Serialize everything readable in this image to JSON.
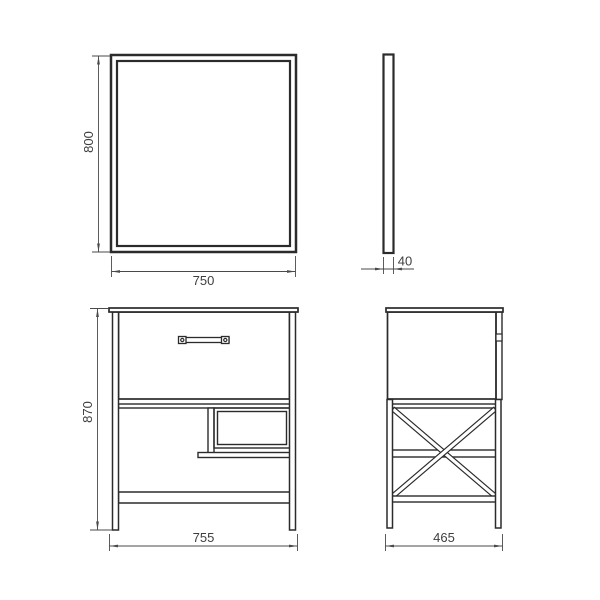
{
  "page": {
    "background_color": "#ffffff",
    "outline_color": "#2b2b2b",
    "dimension_color": "#4a4a4a"
  },
  "drawing": {
    "type": "technical-drawing",
    "subject": "bathroom mirror and vanity cabinet, four orthographic views",
    "views": [
      {
        "id": "mirror-front-view",
        "position": "top-left"
      },
      {
        "id": "mirror-side-view",
        "position": "top-right"
      },
      {
        "id": "cabinet-front-view",
        "position": "bottom-left"
      },
      {
        "id": "cabinet-side-view",
        "position": "bottom-right"
      }
    ]
  },
  "dims": {
    "mirror_height": "800",
    "mirror_width": "750",
    "mirror_depth": "40",
    "cabinet_height": "870",
    "cabinet_width": "755",
    "cabinet_depth": "465"
  }
}
